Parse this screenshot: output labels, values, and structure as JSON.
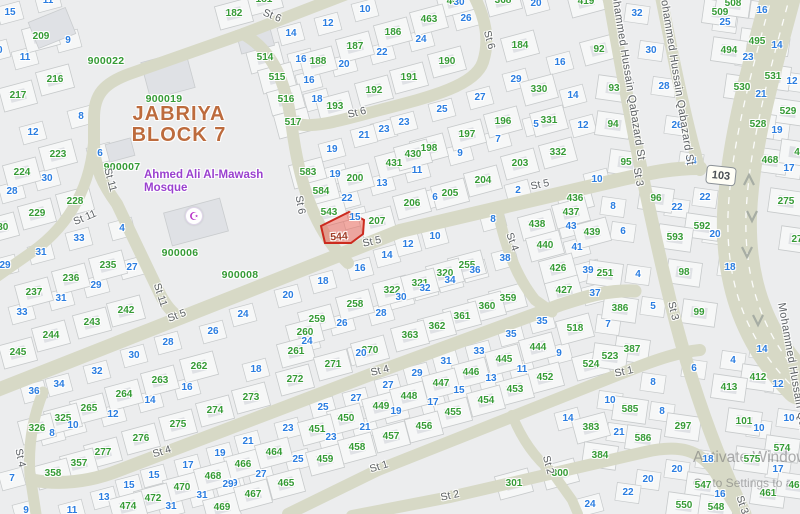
{
  "title": {
    "line1": "JABRIYA",
    "line2": "BLOCK 7"
  },
  "mosque": {
    "line1": "Ahmed Ali Al-Mawash",
    "line2": "Mosque",
    "icon": "mosque-crescent-icon",
    "x": 193,
    "y": 215
  },
  "highlight": {
    "plot_number": "544",
    "label_x": 339,
    "label_y": 237,
    "points": "321,226 349,212 364,220 363,234 351,243 325,243"
  },
  "badge": {
    "route": "103"
  },
  "watermark": {
    "line1": "Activate Windows",
    "line2": "Go to Settings to a"
  },
  "colors": {
    "parcel_green": "#359b35",
    "house_blue": "#2a7de1",
    "district": "#bd6b3d",
    "mosque_purple": "#9a41cf",
    "street_text": "#5d6165",
    "road": "#d7d9c6",
    "parcel_fill": "#f6f7f7",
    "parcel_stroke": "#c7cacb",
    "building": "#dfe1e5",
    "highlight_fill": "rgba(236,93,80,0.5)",
    "highlight_stroke": "#cc2a1e"
  },
  "block_ids": [
    [
      "900022",
      106,
      61
    ],
    [
      "900019",
      164,
      99
    ],
    [
      "900007",
      122,
      167
    ],
    [
      "900006",
      180,
      253
    ],
    [
      "900008",
      240,
      275
    ]
  ],
  "streets": [
    [
      "St 6",
      272,
      16,
      22
    ],
    [
      "St 6",
      300,
      205,
      80
    ],
    [
      "St 6",
      489,
      40,
      75
    ],
    [
      "St 6",
      357,
      113,
      -14
    ],
    [
      "St 11",
      110,
      180,
      75
    ],
    [
      "St 11",
      85,
      218,
      -23
    ],
    [
      "St 11",
      160,
      295,
      72
    ],
    [
      "St 5",
      177,
      316,
      -21
    ],
    [
      "St 5",
      372,
      242,
      -13
    ],
    [
      "St 5",
      540,
      185,
      -12
    ],
    [
      "St 4",
      20,
      458,
      78
    ],
    [
      "St 4",
      162,
      452,
      -17
    ],
    [
      "St 4",
      380,
      371,
      -14
    ],
    [
      "St 4",
      512,
      242,
      70
    ],
    [
      "St 1",
      379,
      467,
      -17
    ],
    [
      "St 1",
      624,
      372,
      -12
    ],
    [
      "St 2",
      548,
      465,
      75
    ],
    [
      "St 2",
      450,
      496,
      -12
    ],
    [
      "St 3",
      638,
      177,
      80
    ],
    [
      "St 3",
      673,
      311,
      77
    ],
    [
      "St 3",
      742,
      505,
      72
    ],
    [
      "Mohammed Hussain Qabazard St",
      627,
      73,
      81
    ],
    [
      "Mohammed Hussain Qabazard St",
      676,
      78,
      81
    ],
    [
      "Mohammed Hussain Qabazard St",
      796,
      390,
      80
    ]
  ],
  "parcels": [
    [
      "209",
      41,
      37
    ],
    [
      "216",
      55,
      80
    ],
    [
      "217",
      18,
      96
    ],
    [
      "223",
      58,
      155
    ],
    [
      "181",
      264,
      0
    ],
    [
      "182",
      234,
      14
    ],
    [
      "514",
      265,
      58
    ],
    [
      "515",
      277,
      78
    ],
    [
      "516",
      286,
      100
    ],
    [
      "517",
      293,
      123
    ],
    [
      "188",
      318,
      62
    ],
    [
      "187",
      355,
      47
    ],
    [
      "186",
      393,
      33
    ],
    [
      "192",
      374,
      91
    ],
    [
      "193",
      335,
      107
    ],
    [
      "431",
      394,
      164
    ],
    [
      "462",
      455,
      2
    ],
    [
      "463",
      429,
      20
    ],
    [
      "190",
      447,
      62
    ],
    [
      "191",
      409,
      78
    ],
    [
      "368",
      503,
      1
    ],
    [
      "184",
      520,
      46
    ],
    [
      "419",
      586,
      2
    ],
    [
      "330",
      539,
      90
    ],
    [
      "331",
      549,
      121
    ],
    [
      "332",
      558,
      153
    ],
    [
      "196",
      503,
      122
    ],
    [
      "197",
      467,
      135
    ],
    [
      "198",
      429,
      149
    ],
    [
      "430",
      413,
      155
    ],
    [
      "203",
      520,
      164
    ],
    [
      "92",
      599,
      50
    ],
    [
      "93",
      614,
      89
    ],
    [
      "94",
      613,
      125
    ],
    [
      "95",
      626,
      163
    ],
    [
      "96",
      656,
      199
    ],
    [
      "509",
      720,
      13
    ],
    [
      "508",
      733,
      4
    ],
    [
      "495",
      757,
      42
    ],
    [
      "494",
      729,
      51
    ],
    [
      "531",
      773,
      77
    ],
    [
      "530",
      742,
      88
    ],
    [
      "529",
      788,
      112
    ],
    [
      "528",
      758,
      125
    ],
    [
      "468",
      770,
      161
    ],
    [
      "4",
      797,
      153
    ],
    [
      "224",
      22,
      173
    ],
    [
      "228",
      75,
      202
    ],
    [
      "229",
      37,
      214
    ],
    [
      "230",
      0,
      228
    ],
    [
      "235",
      108,
      266
    ],
    [
      "236",
      71,
      279
    ],
    [
      "237",
      34,
      293
    ],
    [
      "242",
      126,
      311
    ],
    [
      "243",
      92,
      323
    ],
    [
      "244",
      51,
      336
    ],
    [
      "583",
      308,
      173
    ],
    [
      "200",
      355,
      179
    ],
    [
      "584",
      321,
      192
    ],
    [
      "543",
      329,
      213
    ],
    [
      "207",
      377,
      222
    ],
    [
      "322",
      392,
      291
    ],
    [
      "258",
      355,
      305
    ],
    [
      "259",
      317,
      320
    ],
    [
      "260",
      305,
      333
    ],
    [
      "204",
      483,
      181
    ],
    [
      "205",
      450,
      194
    ],
    [
      "206",
      412,
      204
    ],
    [
      "436",
      575,
      199
    ],
    [
      "437",
      571,
      213
    ],
    [
      "438",
      537,
      225
    ],
    [
      "439",
      592,
      233
    ],
    [
      "440",
      545,
      246
    ],
    [
      "426",
      558,
      269
    ],
    [
      "427",
      564,
      291
    ],
    [
      "255",
      467,
      266
    ],
    [
      "320",
      445,
      274
    ],
    [
      "321",
      420,
      284
    ],
    [
      "359",
      508,
      299
    ],
    [
      "360",
      487,
      307
    ],
    [
      "361",
      462,
      317
    ],
    [
      "362",
      437,
      327
    ],
    [
      "363",
      410,
      336
    ],
    [
      "518",
      575,
      329
    ],
    [
      "592",
      702,
      227
    ],
    [
      "593",
      675,
      238
    ],
    [
      "98",
      684,
      273
    ],
    [
      "99",
      699,
      313
    ],
    [
      "251",
      605,
      274
    ],
    [
      "386",
      620,
      309
    ],
    [
      "275",
      786,
      202
    ],
    [
      "27",
      797,
      240
    ],
    [
      "245",
      18,
      353
    ],
    [
      "264",
      124,
      395
    ],
    [
      "263",
      160,
      381
    ],
    [
      "262",
      199,
      367
    ],
    [
      "265",
      89,
      409
    ],
    [
      "325",
      63,
      419
    ],
    [
      "326",
      37,
      429
    ],
    [
      "275",
      178,
      425
    ],
    [
      "276",
      141,
      439
    ],
    [
      "277",
      103,
      453
    ],
    [
      "357",
      79,
      464
    ],
    [
      "358",
      53,
      474
    ],
    [
      "470",
      182,
      488
    ],
    [
      "472",
      153,
      499
    ],
    [
      "474",
      128,
      507
    ],
    [
      "469",
      222,
      508
    ],
    [
      "467",
      253,
      495
    ],
    [
      "465",
      286,
      484
    ],
    [
      "466",
      243,
      465
    ],
    [
      "464",
      274,
      453
    ],
    [
      "468",
      213,
      477
    ],
    [
      "261",
      296,
      352
    ],
    [
      "270",
      370,
      351
    ],
    [
      "271",
      333,
      365
    ],
    [
      "272",
      295,
      380
    ],
    [
      "273",
      251,
      398
    ],
    [
      "274",
      215,
      411
    ],
    [
      "449",
      381,
      407
    ],
    [
      "450",
      346,
      419
    ],
    [
      "451",
      317,
      430
    ],
    [
      "457",
      391,
      437
    ],
    [
      "458",
      357,
      448
    ],
    [
      "459",
      325,
      460
    ],
    [
      "444",
      538,
      348
    ],
    [
      "445",
      504,
      360
    ],
    [
      "446",
      471,
      373
    ],
    [
      "447",
      441,
      384
    ],
    [
      "448",
      409,
      397
    ],
    [
      "452",
      545,
      378
    ],
    [
      "453",
      515,
      390
    ],
    [
      "454",
      486,
      401
    ],
    [
      "455",
      453,
      413
    ],
    [
      "456",
      424,
      427
    ],
    [
      "524",
      591,
      365
    ],
    [
      "383",
      591,
      428
    ],
    [
      "384",
      600,
      456
    ],
    [
      "300",
      560,
      474
    ],
    [
      "301",
      514,
      484
    ],
    [
      "387",
      632,
      350
    ],
    [
      "523",
      610,
      357
    ],
    [
      "412",
      758,
      378
    ],
    [
      "413",
      729,
      388
    ],
    [
      "585",
      630,
      410
    ],
    [
      "101",
      744,
      422
    ],
    [
      "297",
      683,
      427
    ],
    [
      "586",
      643,
      439
    ],
    [
      "574",
      782,
      449
    ],
    [
      "575",
      752,
      460
    ],
    [
      "547",
      703,
      486
    ],
    [
      "550",
      684,
      506
    ],
    [
      "548",
      716,
      508
    ],
    [
      "461",
      768,
      494
    ],
    [
      "46",
      794,
      486
    ]
  ],
  "houses": [
    [
      "11",
      48,
      1
    ],
    [
      "15",
      10,
      13
    ],
    [
      "9",
      68,
      41
    ],
    [
      "11",
      25,
      58
    ],
    [
      "10",
      -3,
      51
    ],
    [
      "8",
      81,
      117
    ],
    [
      "12",
      33,
      133
    ],
    [
      "6",
      100,
      154
    ],
    [
      "30",
      47,
      179
    ],
    [
      "28",
      12,
      192
    ],
    [
      "4",
      122,
      229
    ],
    [
      "33",
      79,
      239
    ],
    [
      "31",
      41,
      253
    ],
    [
      "29",
      5,
      266
    ],
    [
      "27",
      132,
      268
    ],
    [
      "29",
      96,
      286
    ],
    [
      "31",
      61,
      299
    ],
    [
      "33",
      22,
      313
    ],
    [
      "10",
      365,
      10
    ],
    [
      "12",
      328,
      24
    ],
    [
      "14",
      291,
      34
    ],
    [
      "16",
      301,
      60
    ],
    [
      "22",
      382,
      53
    ],
    [
      "20",
      344,
      65
    ],
    [
      "16",
      309,
      81
    ],
    [
      "18",
      317,
      100
    ],
    [
      "23",
      384,
      130
    ],
    [
      "21",
      364,
      136
    ],
    [
      "19",
      332,
      150
    ],
    [
      "30",
      459,
      3
    ],
    [
      "26",
      466,
      19
    ],
    [
      "24",
      421,
      40
    ],
    [
      "20",
      536,
      4
    ],
    [
      "16",
      560,
      63
    ],
    [
      "29",
      516,
      80
    ],
    [
      "14",
      573,
      96
    ],
    [
      "27",
      480,
      98
    ],
    [
      "25",
      442,
      110
    ],
    [
      "23",
      404,
      123
    ],
    [
      "12",
      583,
      126
    ],
    [
      "5",
      536,
      125
    ],
    [
      "7",
      498,
      140
    ],
    [
      "9",
      460,
      154
    ],
    [
      "19",
      335,
      175
    ],
    [
      "13",
      382,
      184
    ],
    [
      "22",
      347,
      199
    ],
    [
      "15",
      355,
      218
    ],
    [
      "11",
      417,
      171
    ],
    [
      "14",
      387,
      256
    ],
    [
      "16",
      360,
      269
    ],
    [
      "18",
      323,
      282
    ],
    [
      "20",
      288,
      296
    ],
    [
      "24",
      243,
      315
    ],
    [
      "26",
      213,
      332
    ],
    [
      "28",
      381,
      314
    ],
    [
      "26",
      342,
      324
    ],
    [
      "8",
      493,
      220
    ],
    [
      "10",
      435,
      237
    ],
    [
      "12",
      408,
      245
    ],
    [
      "6",
      435,
      198
    ],
    [
      "2",
      518,
      191
    ],
    [
      "38",
      505,
      259
    ],
    [
      "36",
      475,
      271
    ],
    [
      "34",
      450,
      281
    ],
    [
      "32",
      425,
      289
    ],
    [
      "30",
      401,
      298
    ],
    [
      "43",
      571,
      227
    ],
    [
      "41",
      577,
      248
    ],
    [
      "39",
      588,
      271
    ],
    [
      "37",
      595,
      294
    ],
    [
      "35",
      542,
      322
    ],
    [
      "35",
      511,
      335
    ],
    [
      "22",
      705,
      198
    ],
    [
      "22",
      677,
      208
    ],
    [
      "20",
      715,
      235
    ],
    [
      "18",
      730,
      268
    ],
    [
      "8",
      613,
      207
    ],
    [
      "6",
      623,
      232
    ],
    [
      "4",
      638,
      275
    ],
    [
      "5",
      653,
      307
    ],
    [
      "7",
      608,
      325
    ],
    [
      "10",
      597,
      180
    ],
    [
      "32",
      637,
      14
    ],
    [
      "30",
      651,
      51
    ],
    [
      "28",
      664,
      87
    ],
    [
      "26",
      677,
      126
    ],
    [
      "24",
      691,
      162
    ],
    [
      "16",
      762,
      11
    ],
    [
      "25",
      725,
      23
    ],
    [
      "14",
      777,
      46
    ],
    [
      "23",
      748,
      58
    ],
    [
      "12",
      792,
      82
    ],
    [
      "21",
      761,
      95
    ],
    [
      "19",
      777,
      131
    ],
    [
      "17",
      789,
      169
    ],
    [
      "28",
      168,
      343
    ],
    [
      "30",
      134,
      356
    ],
    [
      "32",
      97,
      372
    ],
    [
      "34",
      59,
      385
    ],
    [
      "36",
      34,
      392
    ],
    [
      "16",
      187,
      388
    ],
    [
      "14",
      150,
      401
    ],
    [
      "12",
      113,
      415
    ],
    [
      "10",
      73,
      426
    ],
    [
      "8",
      52,
      434
    ],
    [
      "7",
      12,
      479
    ],
    [
      "17",
      188,
      466
    ],
    [
      "15",
      154,
      476
    ],
    [
      "15",
      129,
      486
    ],
    [
      "13",
      104,
      498
    ],
    [
      "11",
      72,
      511
    ],
    [
      "9",
      26,
      511
    ],
    [
      "31",
      171,
      507
    ],
    [
      "31",
      202,
      496
    ],
    [
      "29",
      232,
      484
    ],
    [
      "24",
      307,
      342
    ],
    [
      "20",
      361,
      354
    ],
    [
      "18",
      256,
      370
    ],
    [
      "27",
      356,
      399
    ],
    [
      "27",
      388,
      386
    ],
    [
      "25",
      323,
      408
    ],
    [
      "23",
      331,
      438
    ],
    [
      "23",
      288,
      429
    ],
    [
      "21",
      365,
      428
    ],
    [
      "21",
      248,
      442
    ],
    [
      "19",
      396,
      412
    ],
    [
      "19",
      220,
      454
    ],
    [
      "25",
      298,
      460
    ],
    [
      "27",
      261,
      475
    ],
    [
      "29",
      228,
      485
    ],
    [
      "33",
      479,
      352
    ],
    [
      "31",
      446,
      362
    ],
    [
      "29",
      417,
      374
    ],
    [
      "9",
      559,
      354
    ],
    [
      "11",
      522,
      370
    ],
    [
      "13",
      491,
      379
    ],
    [
      "15",
      459,
      391
    ],
    [
      "17",
      433,
      403
    ],
    [
      "14",
      568,
      419
    ],
    [
      "24",
      590,
      505
    ],
    [
      "14",
      762,
      350
    ],
    [
      "4",
      733,
      361
    ],
    [
      "12",
      778,
      385
    ],
    [
      "6",
      694,
      369
    ],
    [
      "8",
      653,
      383
    ],
    [
      "8",
      662,
      412
    ],
    [
      "10",
      610,
      401
    ],
    [
      "10",
      789,
      419
    ],
    [
      "10",
      759,
      429
    ],
    [
      "21",
      619,
      433
    ],
    [
      "18",
      708,
      460
    ],
    [
      "17",
      778,
      470
    ],
    [
      "20",
      677,
      470
    ],
    [
      "20",
      648,
      480
    ],
    [
      "22",
      628,
      493
    ],
    [
      "16",
      720,
      495
    ]
  ],
  "roads": [
    {
      "d": "M 352,-8 L 243,34 L 132,73 C 103,83 94,95 94,118 L 94,143 C 94,168 104,186 117,204 L 160,294 Q 168,310 180,318",
      "w": 12
    },
    {
      "d": "M 94,135 C 92,185 70,225 32,252 L -8,280",
      "w": 11
    },
    {
      "d": "M 243,34 C 276,52 286,88 291,120 C 298,178 312,228 348,263",
      "w": 12
    },
    {
      "d": "M 472,-8 C 486,18 490,40 483,62 C 475,86 430,97 380,110 C 345,119 312,130 294,123",
      "w": 12
    },
    {
      "d": "M -8,392 L 180,318 L 400,231 L 618,180 C 650,173 670,168 700,168",
      "w": 14
    },
    {
      "d": "M 43,392 C 32,420 28,448 30,475 L 36,514",
      "w": 11
    },
    {
      "d": "M 32,480 C 60,485 90,482 120,470 L 380,371 C 450,345 520,320 560,305 C 590,295 610,290 635,291",
      "w": 13
    },
    {
      "d": "M 497,208 C 505,245 515,275 535,300 L 552,312",
      "w": 11
    },
    {
      "d": "M 288,514 L 378,470 L 625,372 C 660,358 680,352 700,350",
      "w": 12
    },
    {
      "d": "M 352,516 L 450,497 L 645,452 C 680,444 700,450 715,472 L 740,514",
      "w": 12
    },
    {
      "d": "M 512,415 C 522,440 535,458 552,472 L 572,500 L 578,514",
      "w": 10
    },
    {
      "d": "M 608,-8 C 620,60 642,185 670,300 C 692,390 718,458 745,514",
      "w": 13
    },
    {
      "d": "M 660,-8 C 670,40 684,115 700,170",
      "w": 12
    },
    {
      "d": "M 782,-8 C 764,60 740,140 737,215 C 735,285 756,340 800,385",
      "w": 40
    }
  ],
  "lane_dashes": [
    "M 773,-8 C 755,60 731,140 728,215 C 726,285 747,340 791,385",
    "M 791,-8 C 773,60 749,140 746,215 C 744,285 765,340 809,385"
  ],
  "arrows": [
    [
      749,
      180,
      "up"
    ],
    [
      752,
      216,
      "down"
    ],
    [
      747,
      252,
      "down"
    ],
    [
      758,
      320,
      "down"
    ]
  ],
  "buildings_extra": [
    [
      168,
      75,
      46,
      38,
      -15
    ],
    [
      196,
      222,
      58,
      34,
      -15
    ],
    [
      52,
      28,
      40,
      28,
      -22
    ],
    [
      255,
      38,
      34,
      24,
      -15
    ],
    [
      120,
      150,
      26,
      18,
      -15
    ]
  ]
}
